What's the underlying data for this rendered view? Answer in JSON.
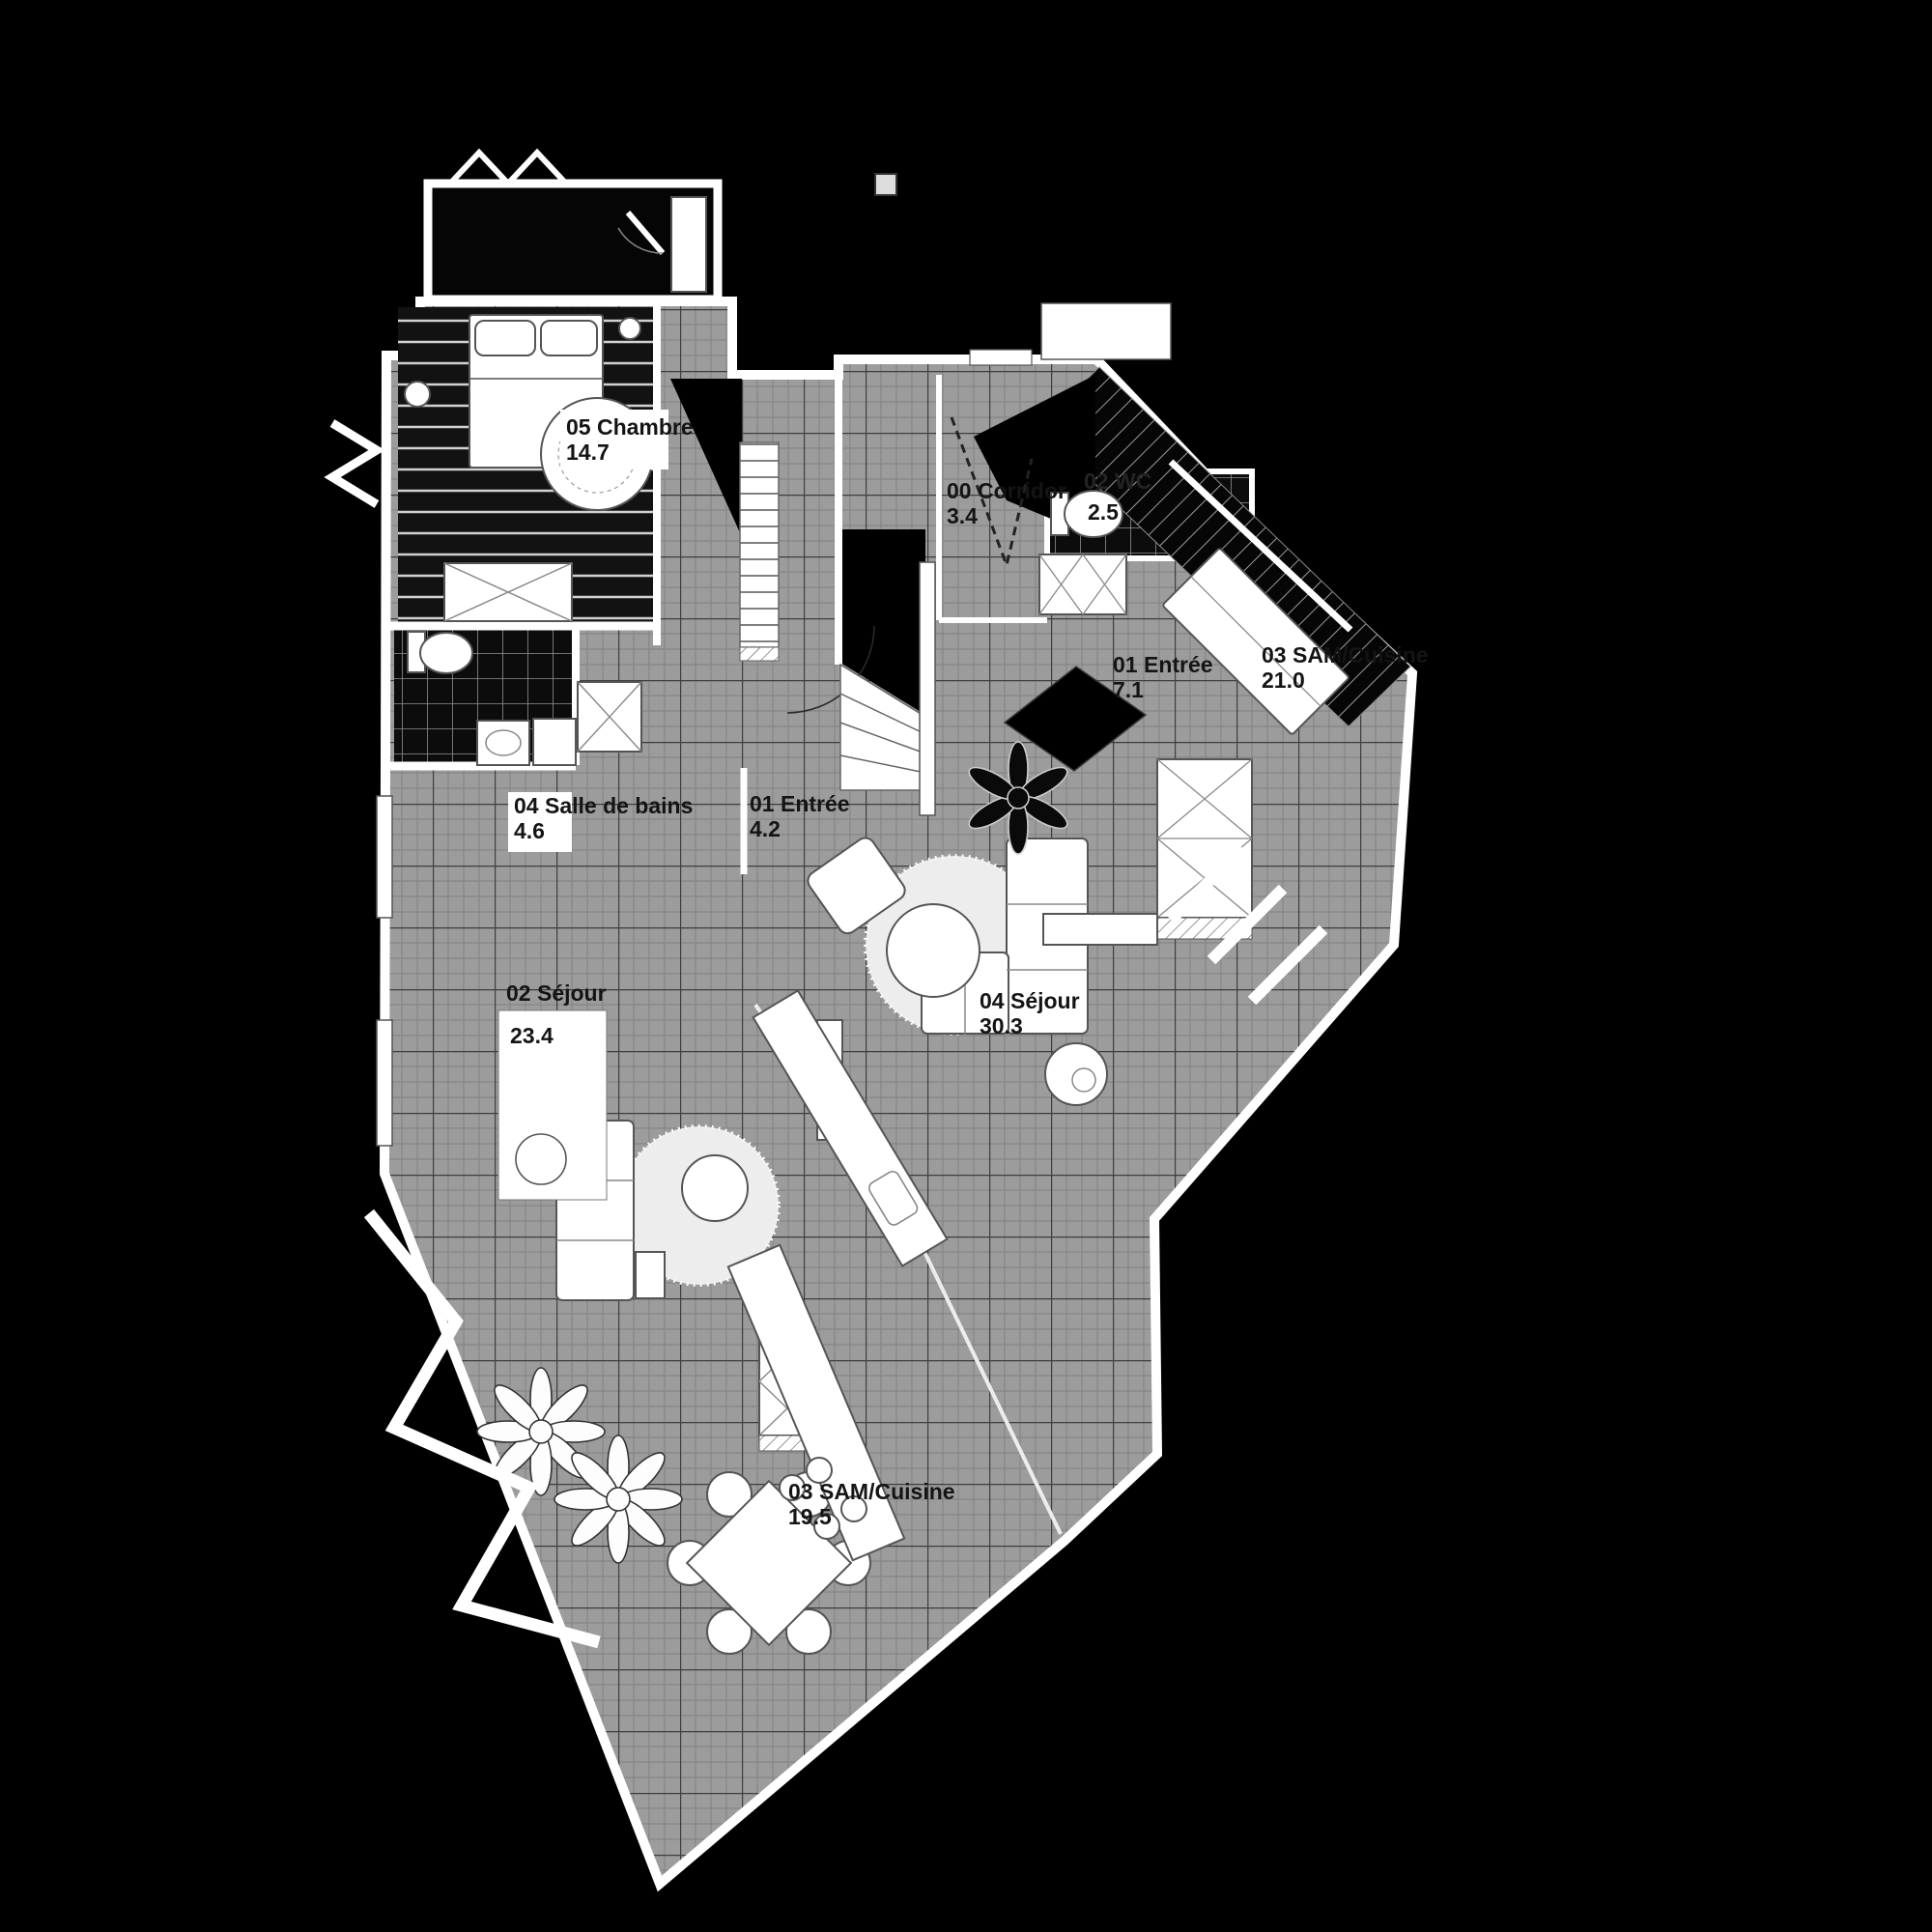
{
  "colors": {
    "background": "#000000",
    "floor_tile": "#9c9c9c",
    "wall": "#ffffff",
    "dark_floor": "#0c0c0c",
    "label_text": "#141414",
    "label_box": "#ffffff"
  },
  "rooms": [
    {
      "name": "05 Chambre",
      "area": "14.7"
    },
    {
      "name": "04 Salle de bains",
      "area": "4.6"
    },
    {
      "name": "01 Entrée",
      "area": "4.2"
    },
    {
      "name": "02 Séjour",
      "area": "23.4"
    },
    {
      "name": "03 SAM/Cuisine",
      "area": "19.5"
    },
    {
      "name": "00 Corridor",
      "area": "3.4"
    },
    {
      "name": "02 WC",
      "area": "2.5"
    },
    {
      "name": "01 Entrée",
      "area": "7.1"
    },
    {
      "name": "03 SAM/Cuisine",
      "area": "21.0"
    },
    {
      "name": "04 Séjour",
      "area": "30.3"
    }
  ]
}
